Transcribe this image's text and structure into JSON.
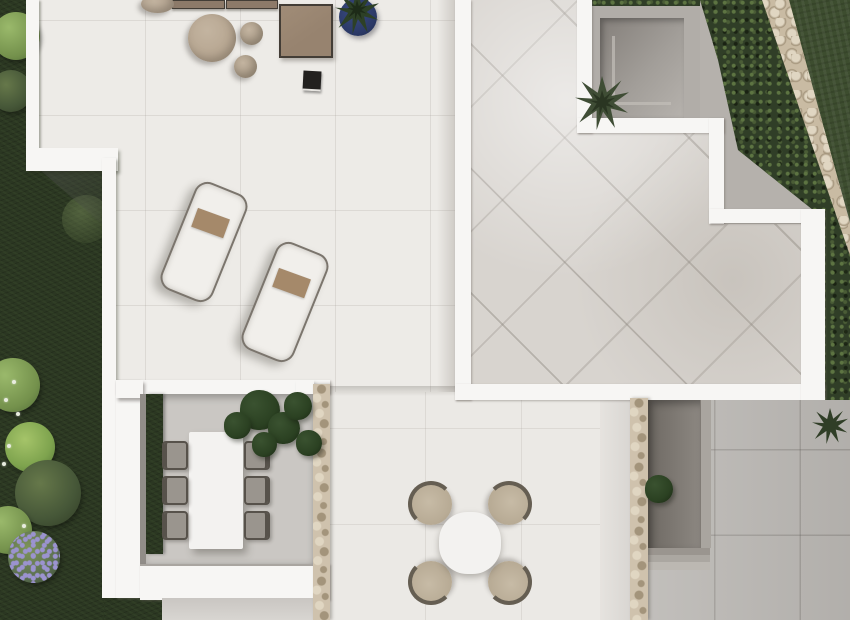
{
  "scene": {
    "type": "aerial-top-down-3d-render",
    "subject": "modern villa roof terraces, sunken patios and garden seen from directly above"
  },
  "colors": {
    "wallWhite": "#f7f6f4",
    "terraceFloor": "#edebe7",
    "tileFloor": "#d8d4cf",
    "grayPath": "#b5b1ac",
    "grayTiles": "#b9b6b2",
    "gardenDark": "#2b3722",
    "lawnGreen": "#3d4d2f",
    "hedgeGreen": "#303e27",
    "hedgeDot": "#5d7442",
    "cobbleBase": "#c9bba3",
    "cobbleDark": "#a3947b",
    "cobbleLight": "#e0d6c2",
    "stoneBase": "#cfc2ad",
    "courtyardWallTop": "#b1ada8",
    "palmGreen": "#3f4d35",
    "diningFloor": "#cac7c3",
    "plantDark": "#2b4122",
    "tableWhite": "#f3f2f0",
    "chairGray": "#9a958e",
    "chairFrame": "#57524b",
    "patioChairBeige": "#b7aa94",
    "patioChairRim": "#655e52",
    "loungerCushion": "#f1efeb",
    "loungerRim": "#7b756d",
    "towelBrown": "#a5896a",
    "sofaBrown": "#8d7a69",
    "sofaDark": "#433d36",
    "tableBrown": "#97836f",
    "poufLarge": "#b5a48f",
    "poufSmall": "#ab9c88",
    "poufEdge": "#b3a390",
    "potNavy": "#2b3966",
    "lanternBlack": "#23211f",
    "purpleFlower": "#9b93cf",
    "bushLight": "#74914c",
    "bushBright": "#7ea34e",
    "bushOlive": "#465738",
    "bushFlowerBase": "#5c7052"
  },
  "areas": {
    "left_terrace": "white sun terrace with loungers and lounge furniture",
    "roof_terrace": "stepped roof terrace with diagonal stone tiles",
    "sunken_patio_top": "recessed courtyard with palm, upper right",
    "sunken_patio_bottom": "recessed courtyard with plant, lower right",
    "dining_patio": "covered dining patio with long table and six chairs",
    "gray_patio": "large gray tiled ground, lower right",
    "garden": "dark planted garden strip, left side",
    "lawn": "dark lawn, upper right corner",
    "hedge": "diagonal hedge band along boundary",
    "stone_wall": "diagonal natural stone boundary wall"
  },
  "furniture": {
    "sofa_modules": [
      {
        "x": 172,
        "y": 0,
        "w": 53,
        "h": 9
      },
      {
        "x": 226,
        "y": 0,
        "w": 52,
        "h": 9
      }
    ],
    "poufs": [
      {
        "x": 188,
        "y": 14,
        "w": 48,
        "h": 48,
        "shade": "poufLarge"
      },
      {
        "x": 240,
        "y": 22,
        "w": 23,
        "h": 23,
        "shade": "poufSmall"
      },
      {
        "x": 234,
        "y": 55,
        "w": 23,
        "h": 23,
        "shade": "poufSmall"
      },
      {
        "x": 141,
        "y": -5,
        "w": 33,
        "h": 18,
        "shade": "poufEdge"
      }
    ],
    "loungers": [
      {
        "x": 176,
        "y": 184,
        "w": 52,
        "h": 112,
        "angle": 22
      },
      {
        "x": 257,
        "y": 244,
        "w": 52,
        "h": 112,
        "angle": 22
      }
    ],
    "dining_chairs": [
      {
        "x": 162,
        "y": 441,
        "side": "left"
      },
      {
        "x": 162,
        "y": 476,
        "side": "left"
      },
      {
        "x": 162,
        "y": 511,
        "side": "left"
      },
      {
        "x": 244,
        "y": 441,
        "side": "right"
      },
      {
        "x": 244,
        "y": 476,
        "side": "right"
      },
      {
        "x": 244,
        "y": 511,
        "side": "right"
      }
    ],
    "patio_chairs": [
      {
        "x": 410,
        "y": 483,
        "angle": 0
      },
      {
        "x": 488,
        "y": 483,
        "angle": 90
      },
      {
        "x": 488,
        "y": 561,
        "angle": 180
      },
      {
        "x": 410,
        "y": 561,
        "angle": 270
      }
    ]
  },
  "vegetation": {
    "bushes": [
      {
        "x": -8,
        "y": 12,
        "d": 48,
        "tone": "light"
      },
      {
        "x": -10,
        "y": 70,
        "d": 42,
        "tone": "olive"
      },
      {
        "x": 62,
        "y": 195,
        "d": 48,
        "tone": "faint"
      },
      {
        "x": -14,
        "y": 358,
        "d": 54,
        "tone": "light"
      },
      {
        "x": 5,
        "y": 422,
        "d": 50,
        "tone": "bright"
      },
      {
        "x": 15,
        "y": 460,
        "d": 66,
        "tone": "olive"
      },
      {
        "x": -16,
        "y": 506,
        "d": 48,
        "tone": "light"
      },
      {
        "x": 8,
        "y": 531,
        "d": 52,
        "tone": "flower"
      }
    ],
    "flower_dots": [
      {
        "x": 4,
        "y": 398
      },
      {
        "x": 16,
        "y": 412
      },
      {
        "x": 7,
        "y": 444
      },
      {
        "x": 2,
        "y": 462
      },
      {
        "x": 22,
        "y": 524
      },
      {
        "x": 12,
        "y": 380
      }
    ],
    "monstera_blobs": [
      {
        "x": 240,
        "y": 390,
        "d": 40
      },
      {
        "x": 268,
        "y": 412,
        "d": 32
      },
      {
        "x": 224,
        "y": 412,
        "d": 27
      },
      {
        "x": 284,
        "y": 392,
        "d": 28
      },
      {
        "x": 252,
        "y": 432,
        "d": 25
      },
      {
        "x": 296,
        "y": 430,
        "d": 26
      }
    ]
  }
}
